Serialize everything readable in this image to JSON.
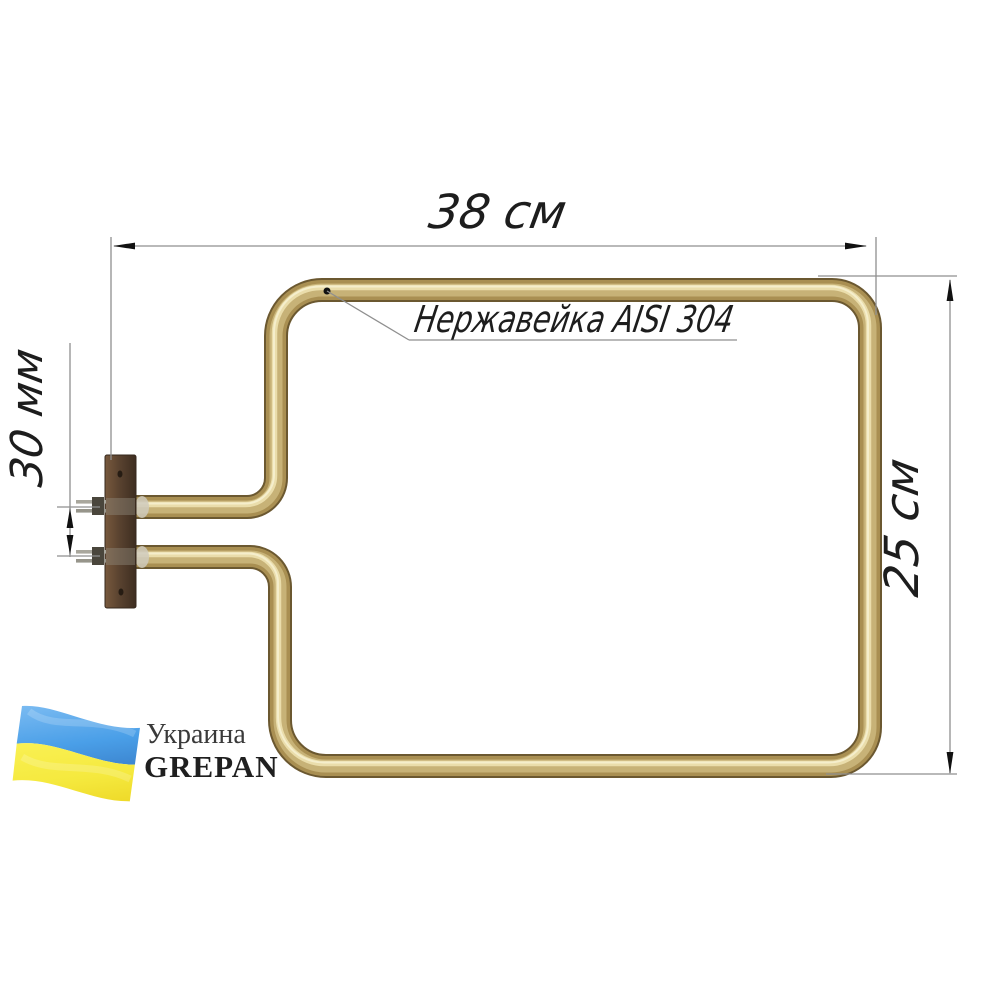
{
  "diagram": {
    "product": "tubular-heating-element",
    "dimensions": {
      "width_label": "38 см",
      "height_label": "25 см",
      "pin_spacing_label": "30 мм"
    },
    "material_callout_label": "Нержавейка AISI 304",
    "branding": {
      "country_label": "Украина",
      "brand_label": "GREPAN",
      "flag_icon": "ukraine-waving-flag"
    },
    "colors": {
      "background": "#ffffff",
      "tube_brass": "#b59a5c",
      "tube_highlight": "#ecdfae",
      "tube_shadow": "#6b5830",
      "bracket_wood_brown": "#5a4330",
      "terminal_metal": "#a9a79d",
      "dimension_line_gray": "#8f8f8f",
      "annotation_text": "#1d1d1d",
      "flag_blue": "#4a9fe8",
      "flag_yellow": "#f5e93e"
    }
  }
}
